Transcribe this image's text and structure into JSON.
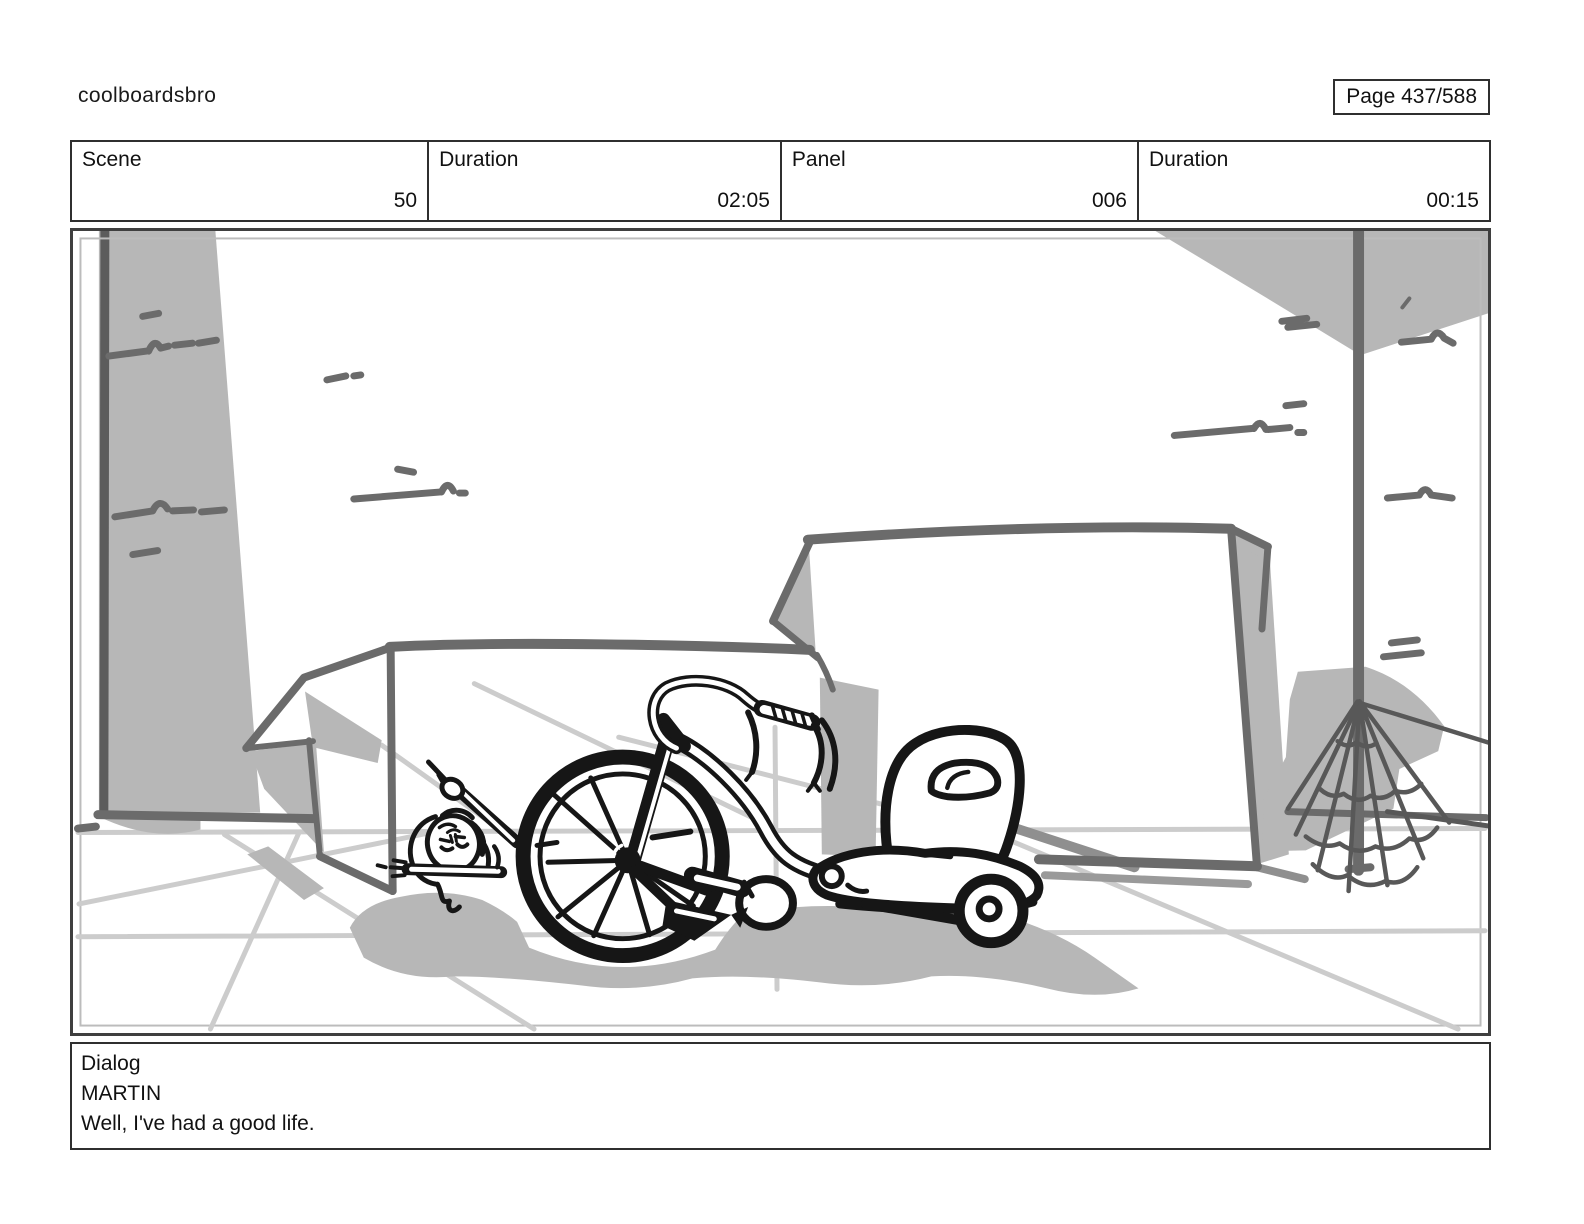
{
  "header": {
    "title": "coolboardsbro",
    "page_label": "Page 437/588"
  },
  "meta": {
    "cells": [
      {
        "label": "Scene",
        "value": "50"
      },
      {
        "label": "Duration",
        "value": "02:05"
      },
      {
        "label": "Panel",
        "value": "006"
      },
      {
        "label": "Duration",
        "value": "00:15"
      }
    ]
  },
  "storyboard": {
    "description": "Hand-drawn storyboard sketch: a big-wheel tricycle in a garage between two open cardboard boxes; a character lies flat on the floor behind the large front wheel with one arm raised; a grey pillar stands at left and a spider web hangs from a pole at right; light perspective guide lines mark the floor.",
    "palette": {
      "ink": "#161616",
      "sketch": "#6b6b6b",
      "shade": "#b7b7b7",
      "guide": "#cccccc"
    }
  },
  "dialog": {
    "label": "Dialog",
    "character": "MARTIN",
    "line": "Well, I've had a good life."
  }
}
